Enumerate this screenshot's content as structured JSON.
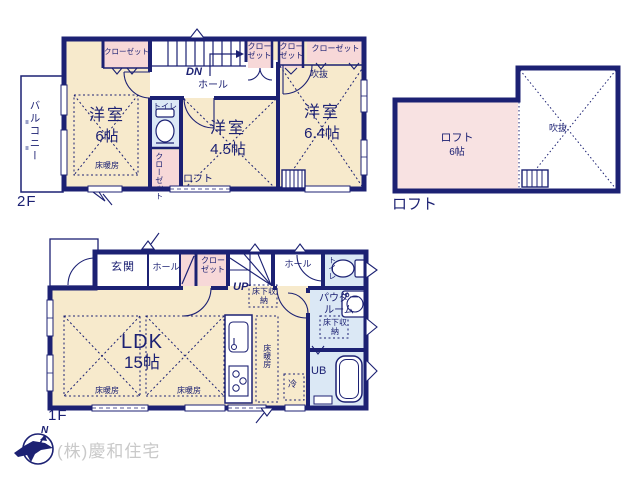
{
  "colors": {
    "wall_navy": "#1c2173",
    "room_cream": "#f7eacc",
    "closet_pink": "#f7d8d8",
    "loft_pink": "#f8e2e2",
    "wet_blue": "#dbe8f5",
    "watermark_gray": "#c9c9c9"
  },
  "floor2": {
    "label": "2F",
    "balcony": "バルコニー",
    "closet1": "クローゼット",
    "closet2": "クローゼット",
    "closet3": "クローゼット",
    "closet4": "クローゼット",
    "closet5": "クローゼット",
    "dn": "DN",
    "hall": "ホール",
    "toilet": "トイレ",
    "loft_access": "ロフト",
    "void": "吹抜",
    "room1": {
      "name": "洋室",
      "size": "6帖",
      "heating": "床暖房"
    },
    "room2": {
      "name": "洋室",
      "size": "4.5帖"
    },
    "room3": {
      "name": "洋室",
      "size": "6.4帖"
    }
  },
  "loft": {
    "plan_label": "ロフト",
    "name": "ロフト",
    "size": "6帖",
    "void": "吹抜"
  },
  "floor1": {
    "label": "1F",
    "entrance": "玄関",
    "hall_front": "ホール",
    "closet": "クローゼット",
    "up": "UP",
    "underfloor1": "床下収納",
    "hall_back": "ホール",
    "toilet": "トイレ",
    "powder": "パウダールーム",
    "underfloor2": "床下収納",
    "fridge": "冷",
    "unit_bath": "UB",
    "heating1": "床暖房",
    "heating2": "床暖房",
    "heating3": "床暖房",
    "ldk": {
      "name": "LDK",
      "size": "15帖"
    }
  },
  "compass": {
    "north": "N"
  },
  "watermark": "(株)慶和住宅"
}
